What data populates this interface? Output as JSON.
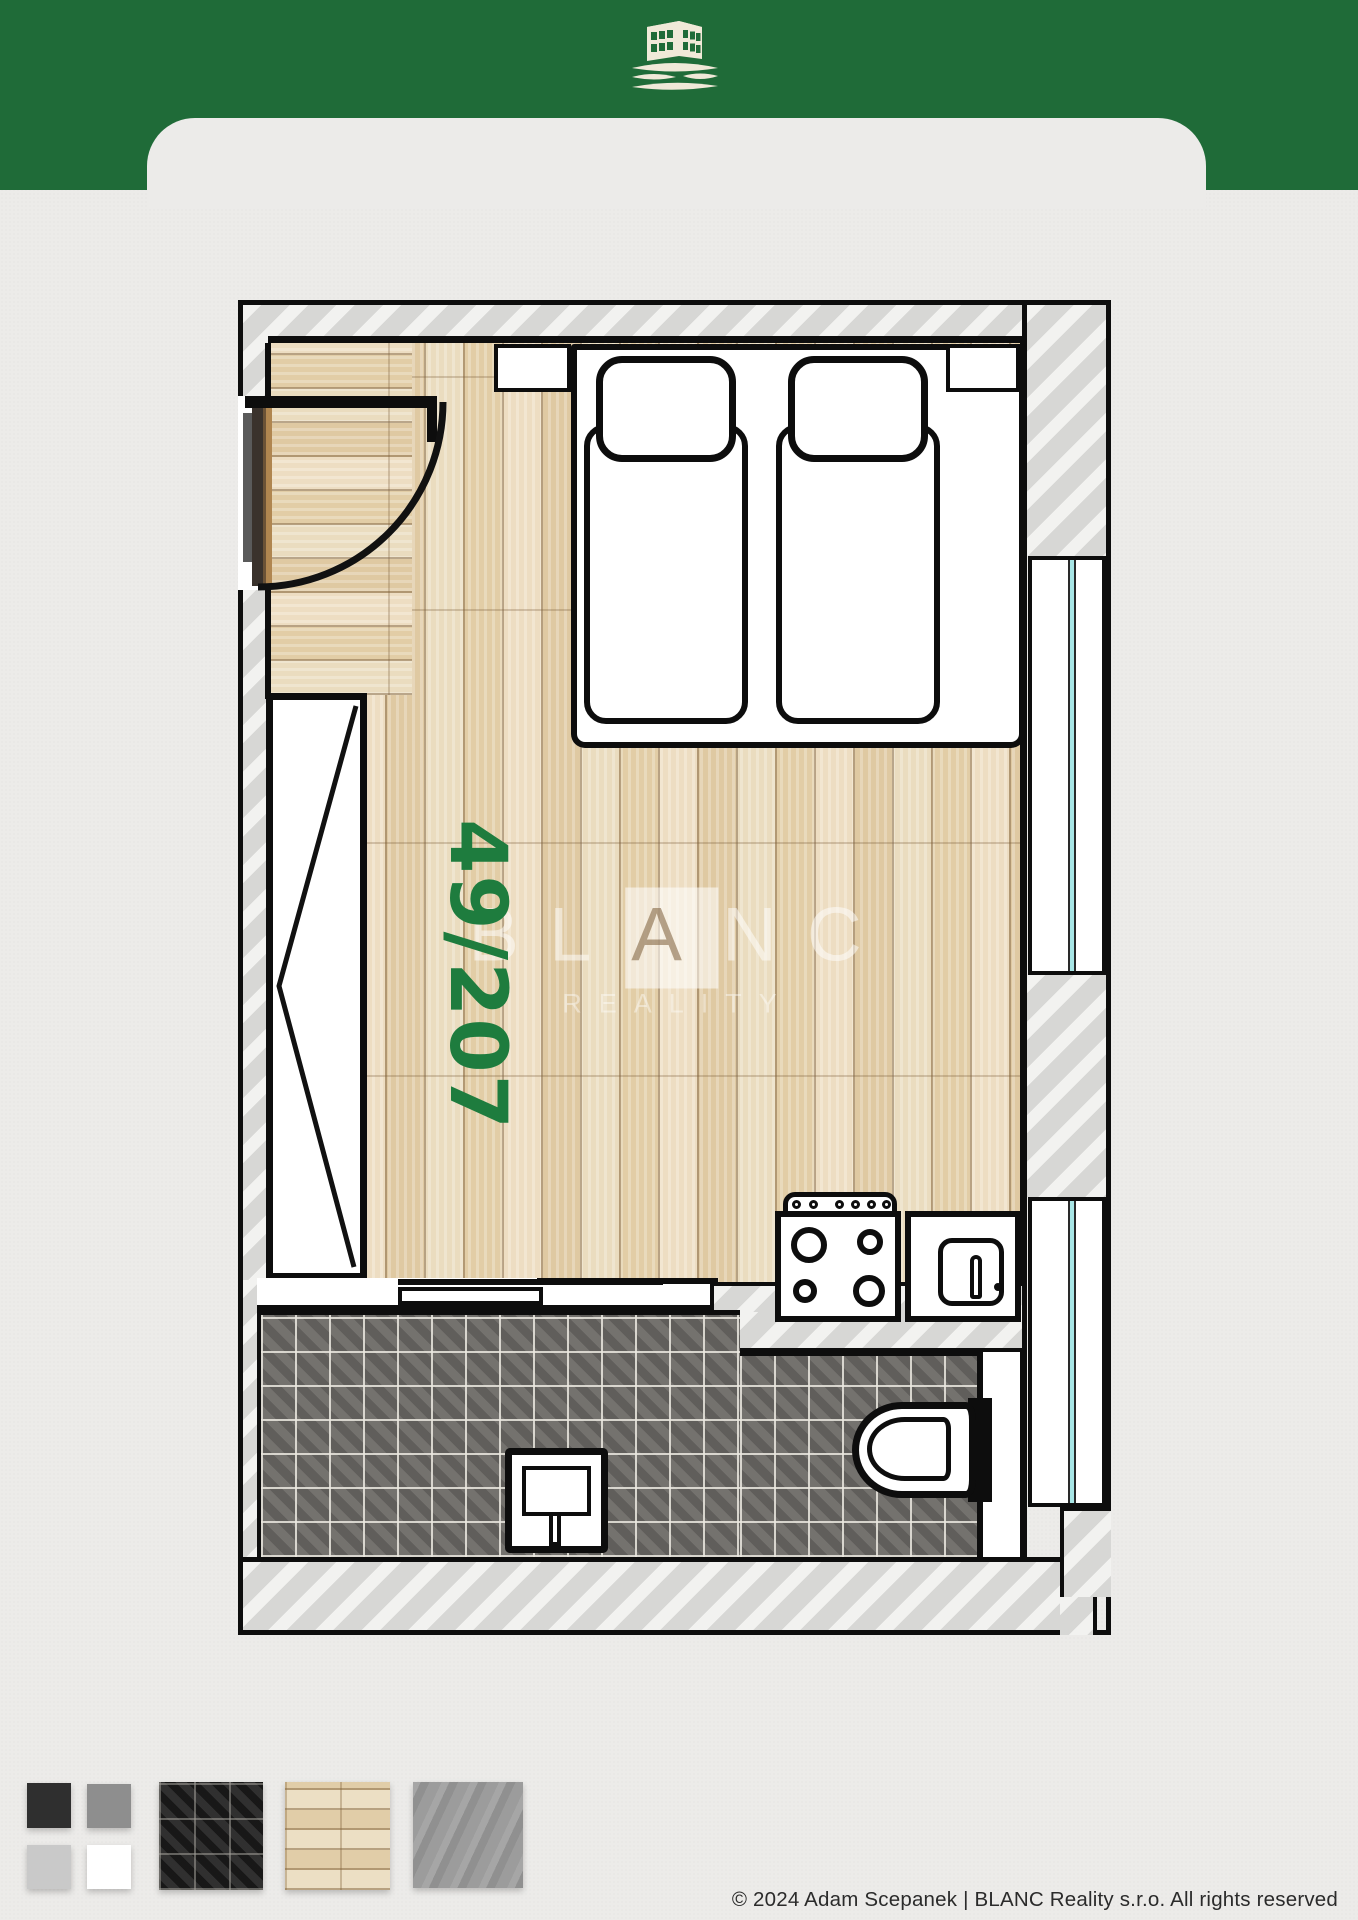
{
  "page": {
    "background_color": "#ecebe9"
  },
  "header": {
    "background_color": "#1f6b38",
    "logo_icon": "building-over-landscape",
    "logo_color": "#f0e9d8"
  },
  "floorplan": {
    "unit_label": "49/207",
    "unit_label_color": "#1e7c3e",
    "watermark": {
      "brand_part1": "BL",
      "brand_boxed_letter": "A",
      "brand_part3": "NC",
      "subtitle": "REALITY"
    },
    "window_glass_color": "#a8e6e6",
    "wall_hatch_colors": [
      "#d7d7d5",
      "#f2f2f0"
    ],
    "floor_wood_color": "#e9d8b8",
    "bathroom_tile_color": "#6d6b68",
    "furniture_icons": [
      "bed-platform",
      "mattress",
      "pillow",
      "wardrobe",
      "entry-door-swing",
      "sliding-door",
      "stove-4-burners",
      "kitchen-sink",
      "toilet",
      "washbasin",
      "window"
    ]
  },
  "legend": {
    "swatches": [
      {
        "name": "paint-dark-gray",
        "color": "#2f2f2f"
      },
      {
        "name": "paint-medium-gray",
        "color": "#8e8e8e"
      },
      {
        "name": "paint-light-gray",
        "color": "#c9c9c9"
      },
      {
        "name": "paint-white",
        "color": "#ffffff"
      },
      {
        "name": "dark-ceramic-tile",
        "color": "#262424"
      },
      {
        "name": "light-wood-parquet",
        "color": "#e8d7b6"
      },
      {
        "name": "gray-concrete",
        "color": "#9c9c9c"
      }
    ]
  },
  "footer": {
    "copyright": "© 2024 Adam Scepanek | BLANC Reality s.r.o. All rights reserved"
  }
}
